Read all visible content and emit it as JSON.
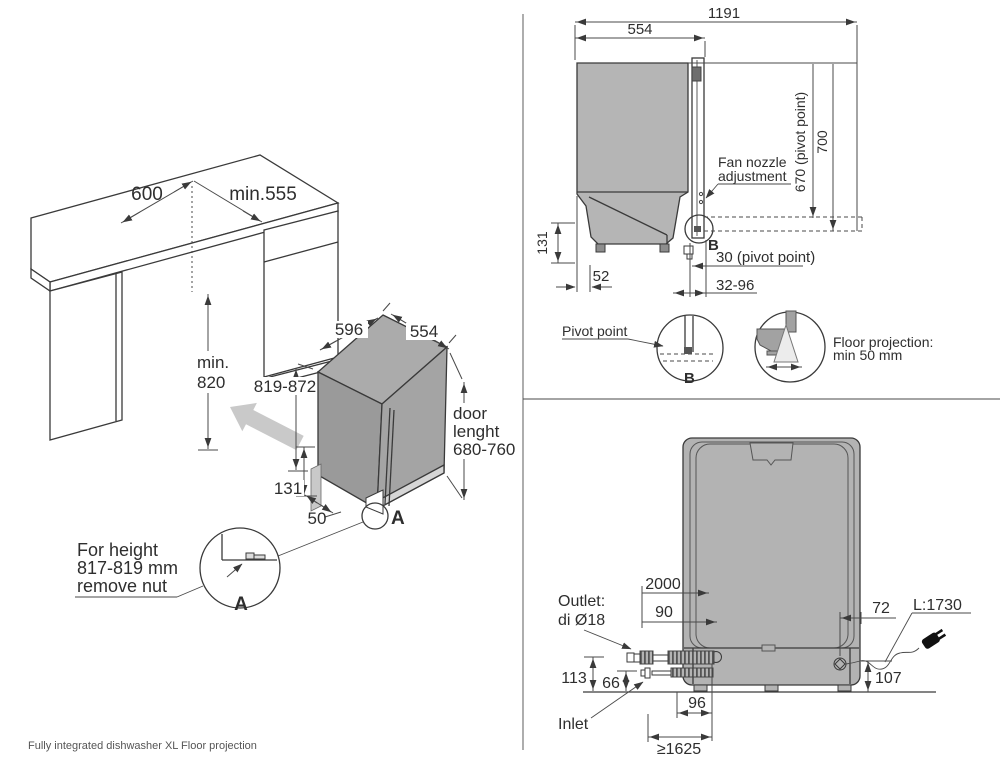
{
  "caption": "Fully integrated dishwasher XL Floor projection",
  "iso": {
    "cab_width": "600",
    "cab_depth": "min.555",
    "niche_h1": "min.",
    "niche_h2": "820",
    "dw_width": "596",
    "dw_depth": "554",
    "dw_height": "819-872",
    "plinth": "131",
    "front_gap": "50",
    "door1": "door",
    "door2": "lenght",
    "door3": "680-760",
    "detail_a": "A",
    "detail_a_big": "A",
    "note1": "For height",
    "note2": "817-819 mm",
    "note3": "remove nut"
  },
  "side": {
    "total": "1191",
    "depth": "554",
    "pivot_height": "670 (pivot point)",
    "total_height": "700",
    "base": "131",
    "rear_gap": "52",
    "pivot": "30 (pivot point)",
    "range": "32-96",
    "fan1": "Fan nozzle",
    "fan2": "adjustment",
    "b1": "B",
    "pivot_label": "Pivot point",
    "b2": "B",
    "fp1": "Floor projection:",
    "fp2": "min 50 mm"
  },
  "rear": {
    "hose": "2000",
    "outlet_off": "90",
    "cord_off": "72",
    "cord_len": "L:1730",
    "outlet1": "Outlet:",
    "outlet2": "di Ø18",
    "h_outlet": "113",
    "h_inlet": "66",
    "h_cord": "107",
    "hose_off": "96",
    "inlet_min": "≥1625",
    "inlet": "Inlet"
  },
  "colors": {
    "line": "#3a3a3a",
    "body_gray": "#b3b3b3",
    "iso_top": "#ababab",
    "iso_side": "#9a9a9a",
    "kick_light": "#d6d6d6",
    "arrow_gray": "#c9c9c9"
  }
}
